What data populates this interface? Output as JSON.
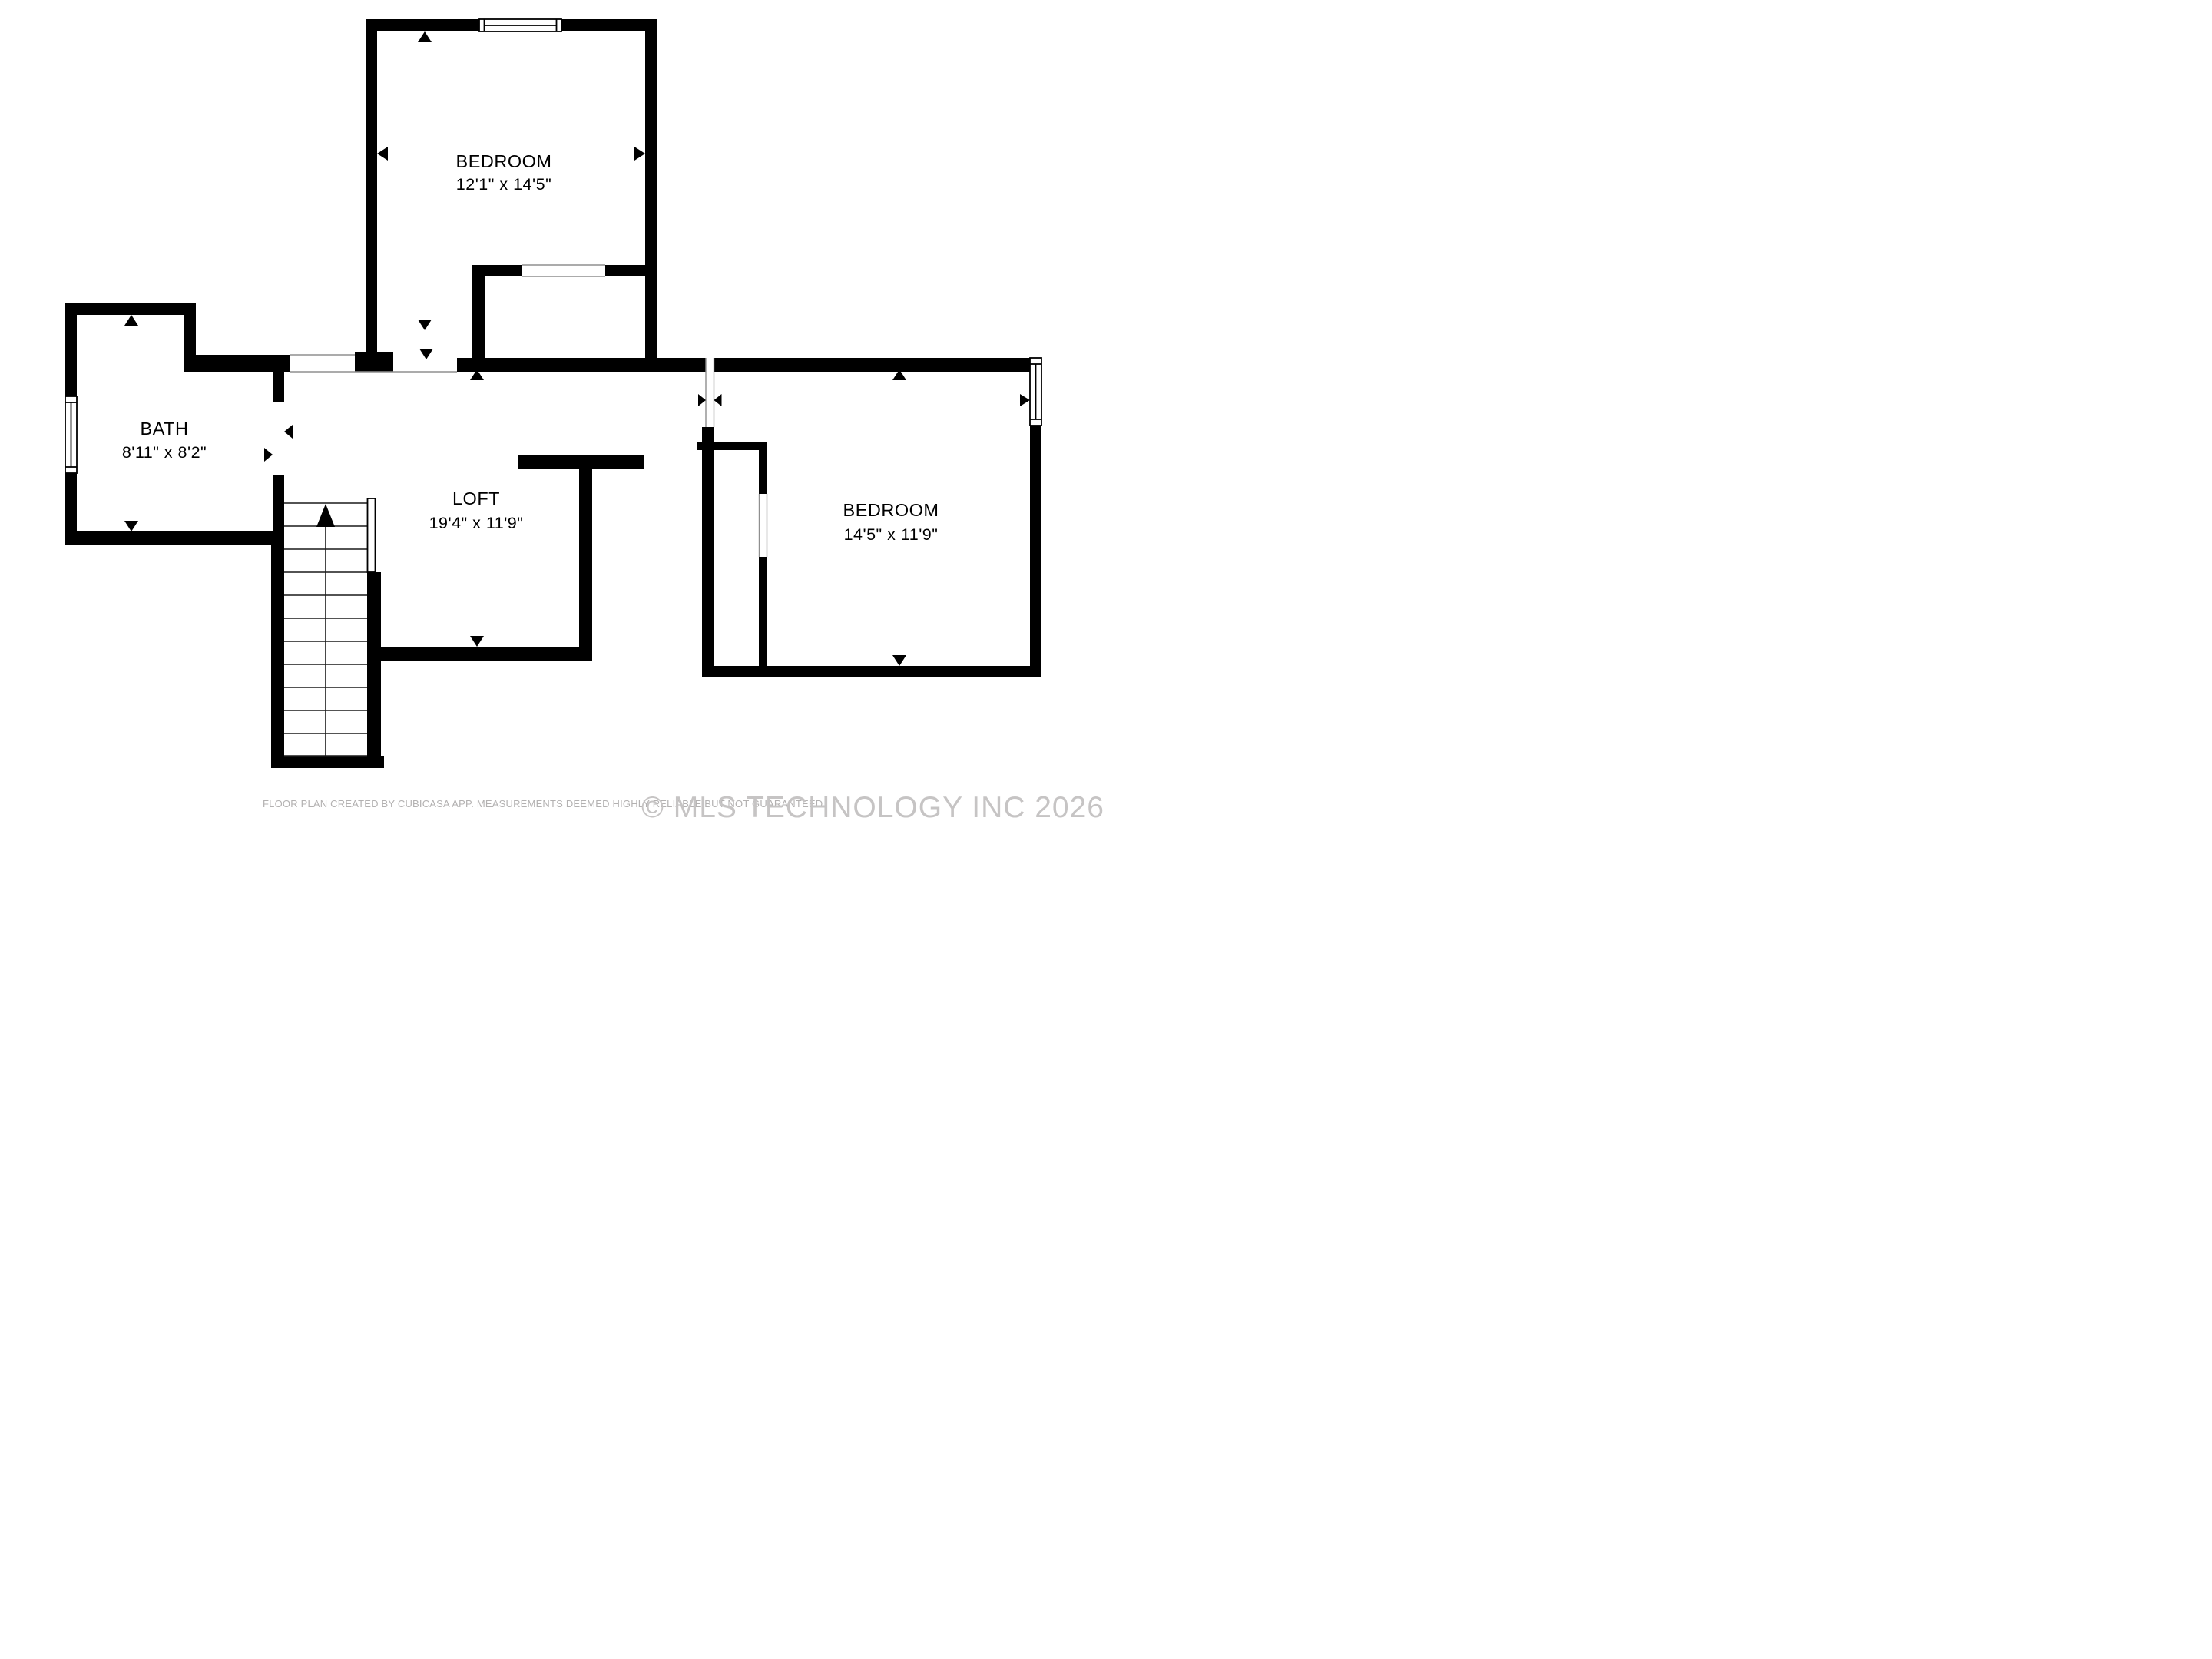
{
  "plan": {
    "rooms": {
      "bedroom_top": {
        "name": "BEDROOM",
        "dims": "12'1\" x 14'5\""
      },
      "bath": {
        "name": "BATH",
        "dims": "8'11\" x 8'2\""
      },
      "loft": {
        "name": "LOFT",
        "dims": "19'4\" x 11'9\""
      },
      "bedroom_right": {
        "name": "BEDROOM",
        "dims": "14'5\" x 11'9\""
      }
    },
    "footer": {
      "disclaimer": "FLOOR PLAN CREATED BY CUBICASA APP. MEASUREMENTS DEEMED HIGHLY RELIABLE BUT NOT GUARANTEED.",
      "watermark": "© MLS TECHNOLOGY INC 2026"
    },
    "colors": {
      "wall": "#000000",
      "background": "#ffffff",
      "thin_line": "#8f8f8f",
      "disclaimer_text": "#b3b1b1",
      "watermark_text": "#c6c4c4"
    }
  }
}
